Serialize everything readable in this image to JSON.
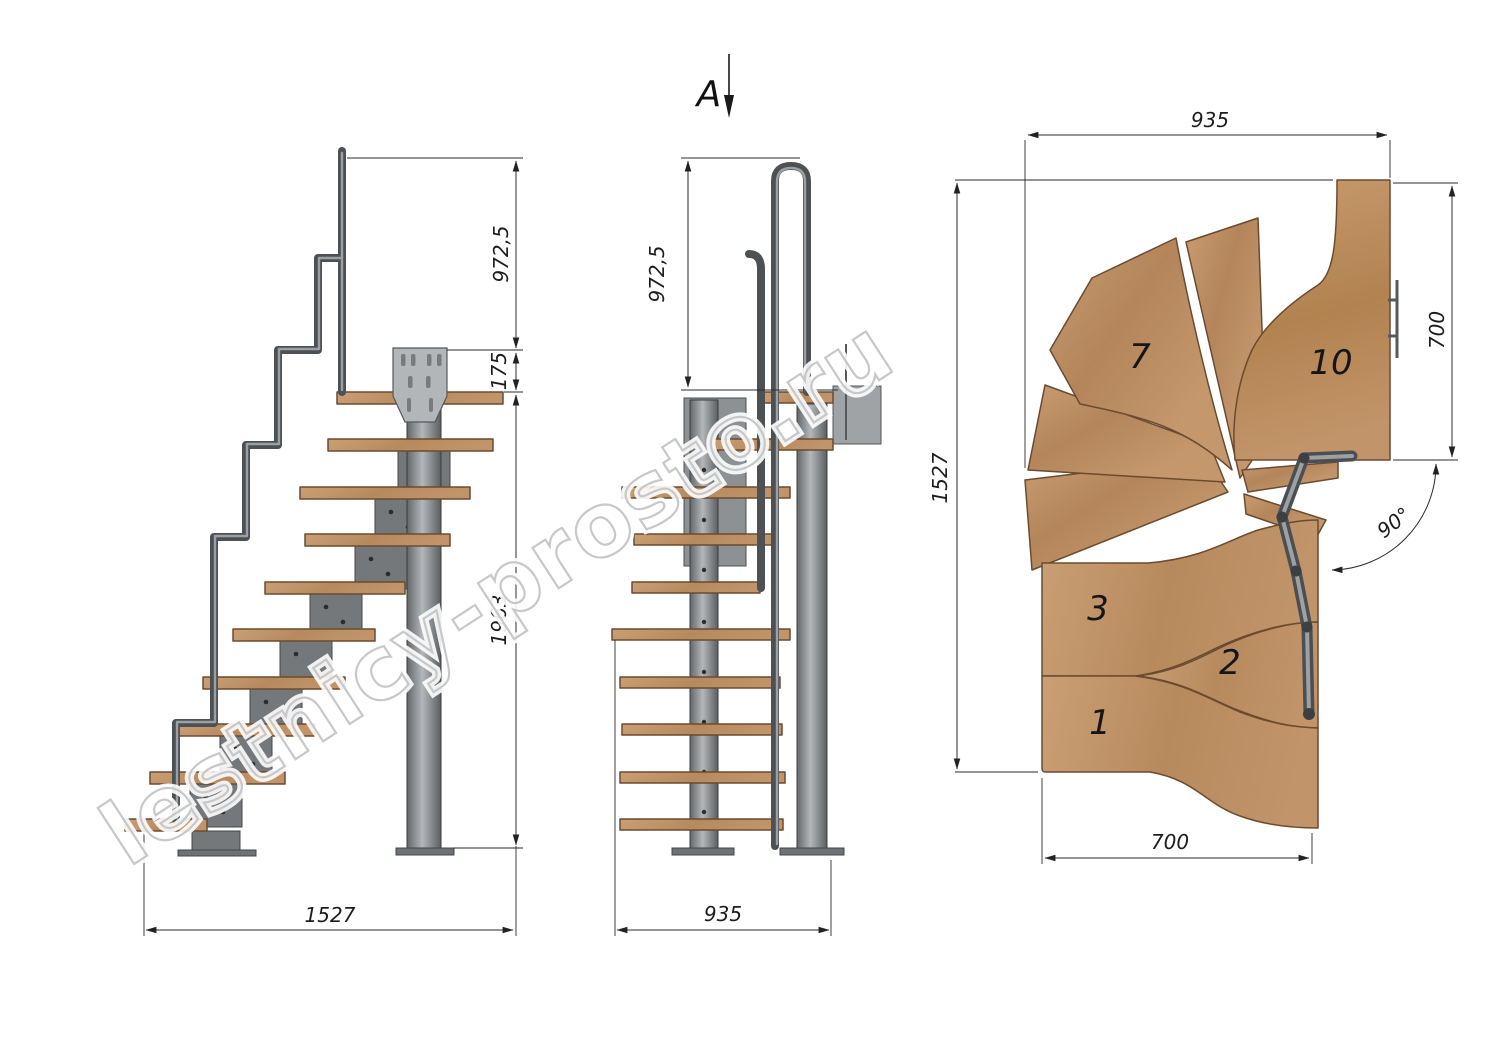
{
  "drawing": {
    "watermark": "lestnicy-prosto.ru",
    "side_view": {
      "dim_rail_height": "972,5",
      "dim_platform_drop": "175",
      "dim_column_height": "1963",
      "dim_total_run": "1527"
    },
    "front_view": {
      "section_label": "A",
      "dim_rail_height": "972,5",
      "dim_width": "935"
    },
    "plan_view": {
      "dim_top_width": "935",
      "dim_landing_depth": "700",
      "dim_total_depth": "1527",
      "dim_flight_width": "700",
      "dim_turn_angle": "90°",
      "tread_labels": {
        "t1": "1",
        "t2": "2",
        "t3": "3",
        "t7": "7",
        "t10": "10"
      }
    }
  }
}
